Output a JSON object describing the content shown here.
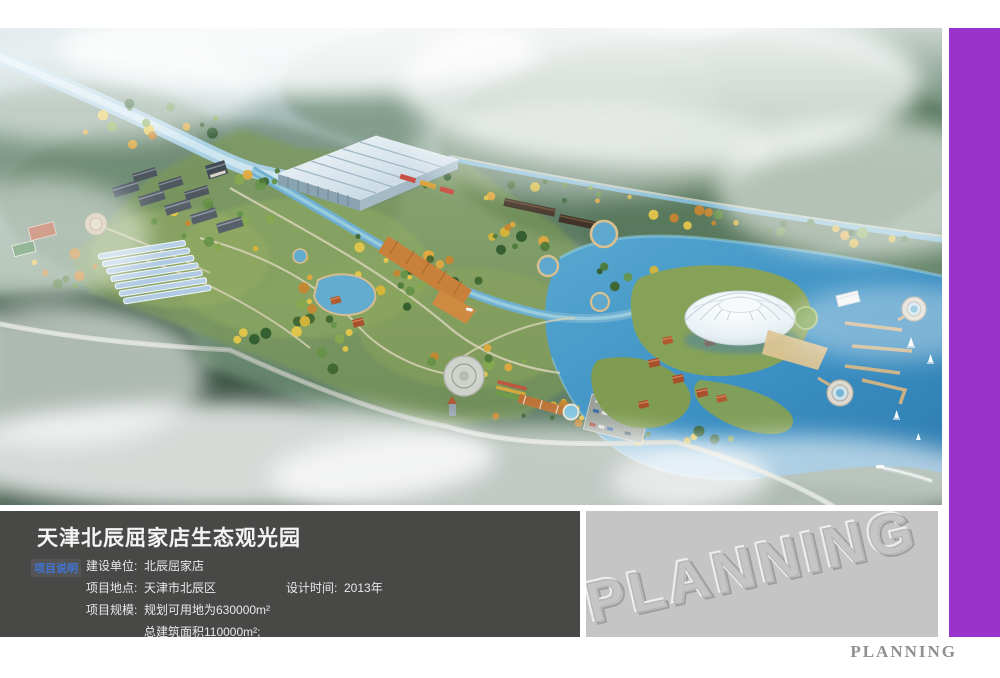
{
  "colors": {
    "accent_purple": "#9933cc",
    "info_panel_bg": "#484847",
    "watermark_panel_bg": "#c5c5c5",
    "section_label_blue": "#3f74d6"
  },
  "info_panel": {
    "title": "天津北辰屈家店生态观光园",
    "section_label": "项目说明",
    "rows": [
      {
        "label": "建设单位:",
        "value": "北辰屈家店"
      },
      {
        "label": "项目地点:",
        "value": "天津市北辰区",
        "label2": "设计时间:",
        "value2": "2013年"
      },
      {
        "label": "项目规模:",
        "value": "规划可用地为630000m²"
      },
      {
        "label": "",
        "value": "总建筑面积110000m²;"
      }
    ]
  },
  "watermark": {
    "text": "PLANNING"
  },
  "footer": {
    "brand": "PLANNING"
  }
}
